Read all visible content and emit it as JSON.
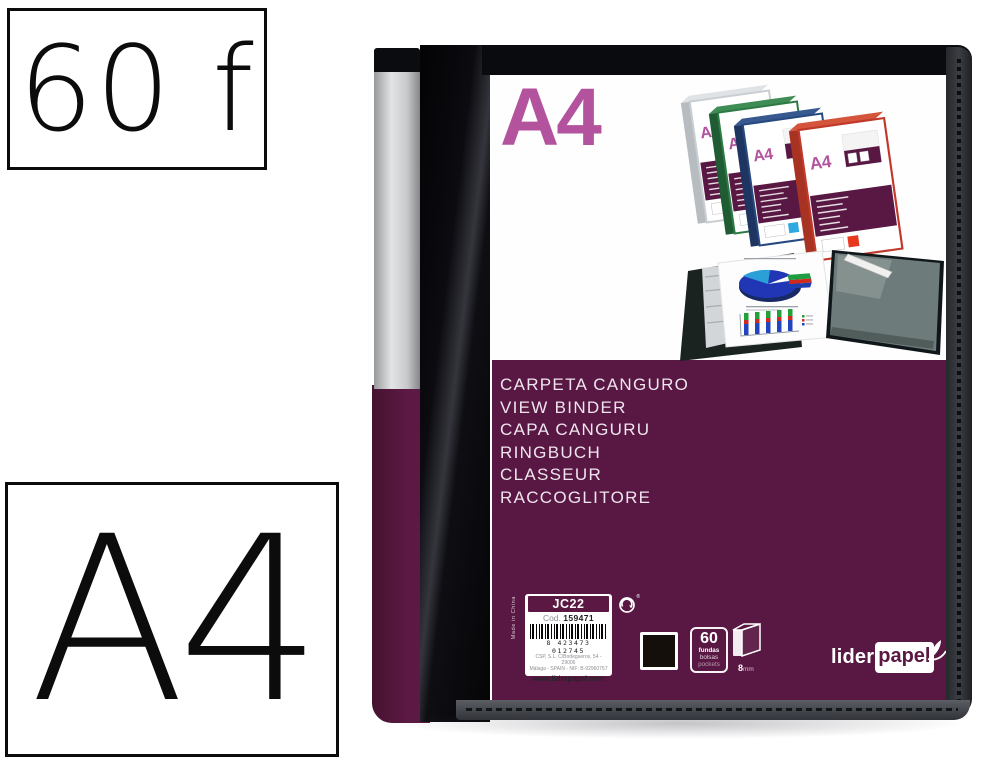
{
  "overlay": {
    "sheets_badge": "60 f",
    "format_badge": "A4"
  },
  "cover": {
    "size_label": "A4",
    "languages": [
      "CARPETA CANGURO",
      "VIEW BINDER",
      "CAPA CANGURU",
      "RINGBUCH",
      "CLASSEUR",
      "RACCOGLITORE"
    ]
  },
  "label": {
    "made_in": "Made in China",
    "model": "JC22",
    "cod_label": "Cod.",
    "cod_value": "159471",
    "barcode_digits": "8 423473 012745",
    "address_line1": "CSP, S.L. C/Bodegueros, 54 - 29006",
    "address_line2": "Málaga - SPAIN - NIF: B-92960757",
    "website": "www.liderpapel.com",
    "registered_mark": "®"
  },
  "specs": {
    "pockets_count": "60",
    "pockets_word_es": "fundas",
    "pockets_word_es2": "bolsas",
    "pockets_word_en": "pockets",
    "spine_size": "8",
    "spine_unit": "mm"
  },
  "brand": {
    "name_part1": "lider",
    "name_part2": "papel"
  },
  "collage": {
    "thumbs": [
      "A4",
      "A4",
      "A4",
      "A4"
    ]
  },
  "colors": {
    "band_purple": "#591843",
    "logo_magenta": "#B4539D",
    "binder_black": "#0B0B10",
    "label_silver": "#C9C9CB",
    "thumb_green": "#2E7A45",
    "thumb_navy": "#27497F",
    "thumb_red": "#C0392B",
    "thumb_silver": "#C9CED3"
  }
}
